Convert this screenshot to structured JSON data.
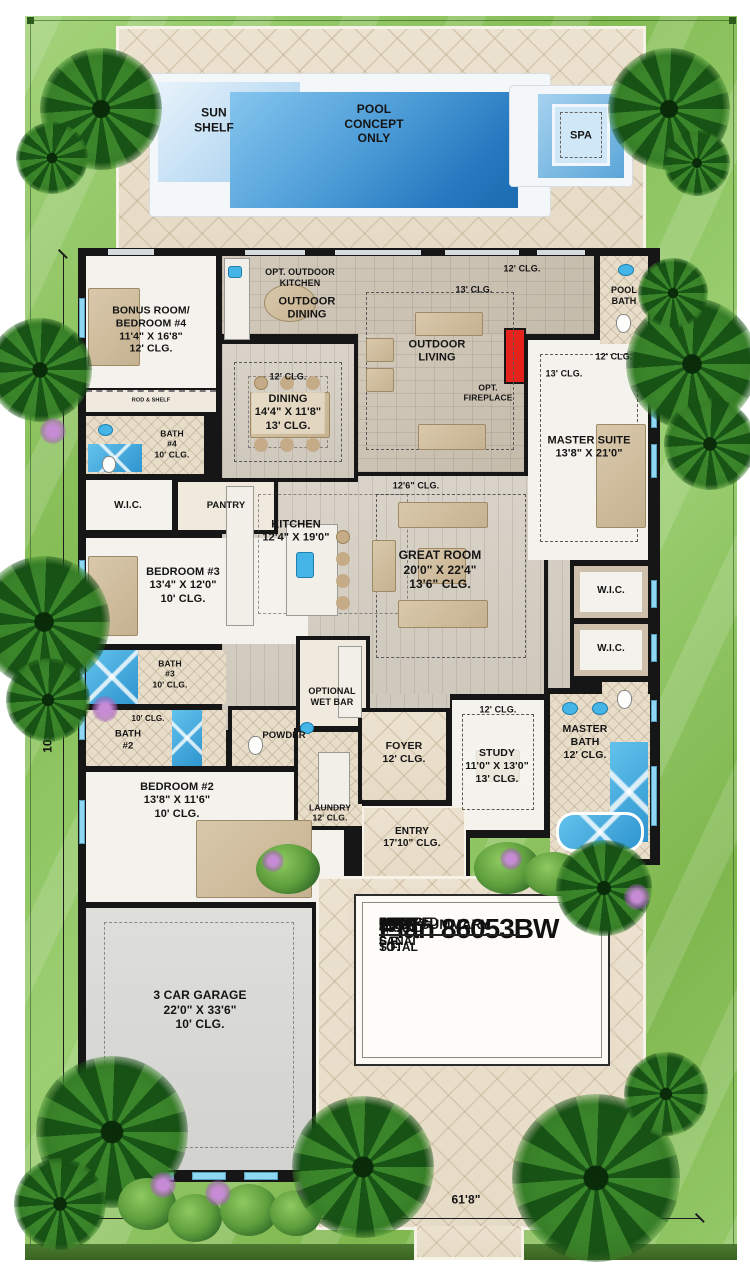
{
  "pool": {
    "sun_shelf": "SUN\nSHELF",
    "concept": "POOL\nCONCEPT\nONLY",
    "spa": "SPA"
  },
  "labels": {
    "opt_outdoor_kitchen": "OPT. OUTDOOR\nKITCHEN",
    "outdoor_dining": "OUTDOOR\nDINING",
    "outdoor_living": "OUTDOOR\nLIVING",
    "opt_fireplace": "OPT.\nFIREPLACE",
    "lanai_clg12": "12' CLG.",
    "lanai_clg13": "13' CLG.",
    "pool_bath": "POOL\nBATH",
    "bonus_room": "BONUS ROOM/\nBEDROOM #4\n11'4\" X 16'8\"\n12' CLG.",
    "rod_shelf": "ROD & SHELF",
    "bath4": "BATH\n#4\n10' CLG.",
    "wic_left": "W.I.C.",
    "pantry": "PANTRY",
    "dining_tray": "12' CLG.",
    "dining": "DINING\n14'4\" X 11'8\"\n13' CLG.",
    "master_clg12": "12' CLG.",
    "master_clg13": "13' CLG.",
    "master_suite": "MASTER SUITE\n13'8\" X 21'0\"",
    "kitchen": "KITCHEN\n12'4\" X 19'0\"",
    "great_tray": "12'6\" CLG.",
    "great_room": "GREAT ROOM\n20'0\" X 22'4\"\n13'6\" CLG.",
    "bedroom3": "BEDROOM #3\n13'4\" X 12'0\"\n10' CLG.",
    "bath3": "BATH\n#3\n10' CLG.",
    "bath2_clg": "10' CLG.",
    "bath2": "BATH\n#2",
    "powder": "POWDER",
    "wic_r1": "W.I.C.",
    "wic_r2": "W.I.C.",
    "opt_wet_bar": "OPTIONAL\nWET BAR",
    "bedroom2": "BEDROOM #2\n13'8\" X 11'6\"\n10' CLG.",
    "laundry": "LAUNDRY\n12' CLG.",
    "foyer": "FOYER\n12' CLG.",
    "entry": "ENTRY\n17'10\" CLG.",
    "study_tray": "12' CLG.",
    "study": "STUDY\n11'0\" X 13'0\"\n13' CLG.",
    "master_bath": "MASTER\nBATH\n12' CLG.",
    "garage": "3 CAR GARAGE\n22'0\" X 33'6\"\n10' CLG."
  },
  "plan_card": {
    "title": "Plan 86053BW",
    "summary_title": "AREA SUMMARY",
    "rows": [
      {
        "label": "LIVING",
        "value": "3,382 S.F."
      },
      {
        "label": "GARAGE",
        "value": "845 S.F."
      },
      {
        "label": "COVERED LANAI",
        "value": "683 S.F."
      },
      {
        "label": "ENTRY",
        "value": "80 S.F."
      }
    ],
    "total": {
      "label": "GRAND TOTAL",
      "value": "4,990 S.F."
    }
  },
  "dimensions": {
    "lot_depth": "103'8\"",
    "lot_width": "61'8\""
  },
  "colors": {
    "pool_blue": "#1b6cb0",
    "water_accent": "#45b4e6",
    "lawn_green": "#85bd55",
    "deck_tan": "#ece2d0",
    "wall_black": "#161616",
    "wood_floor": "#d4cdc2",
    "fireplace_red": "#e5231a",
    "window_blue": "#8fd8f2"
  }
}
